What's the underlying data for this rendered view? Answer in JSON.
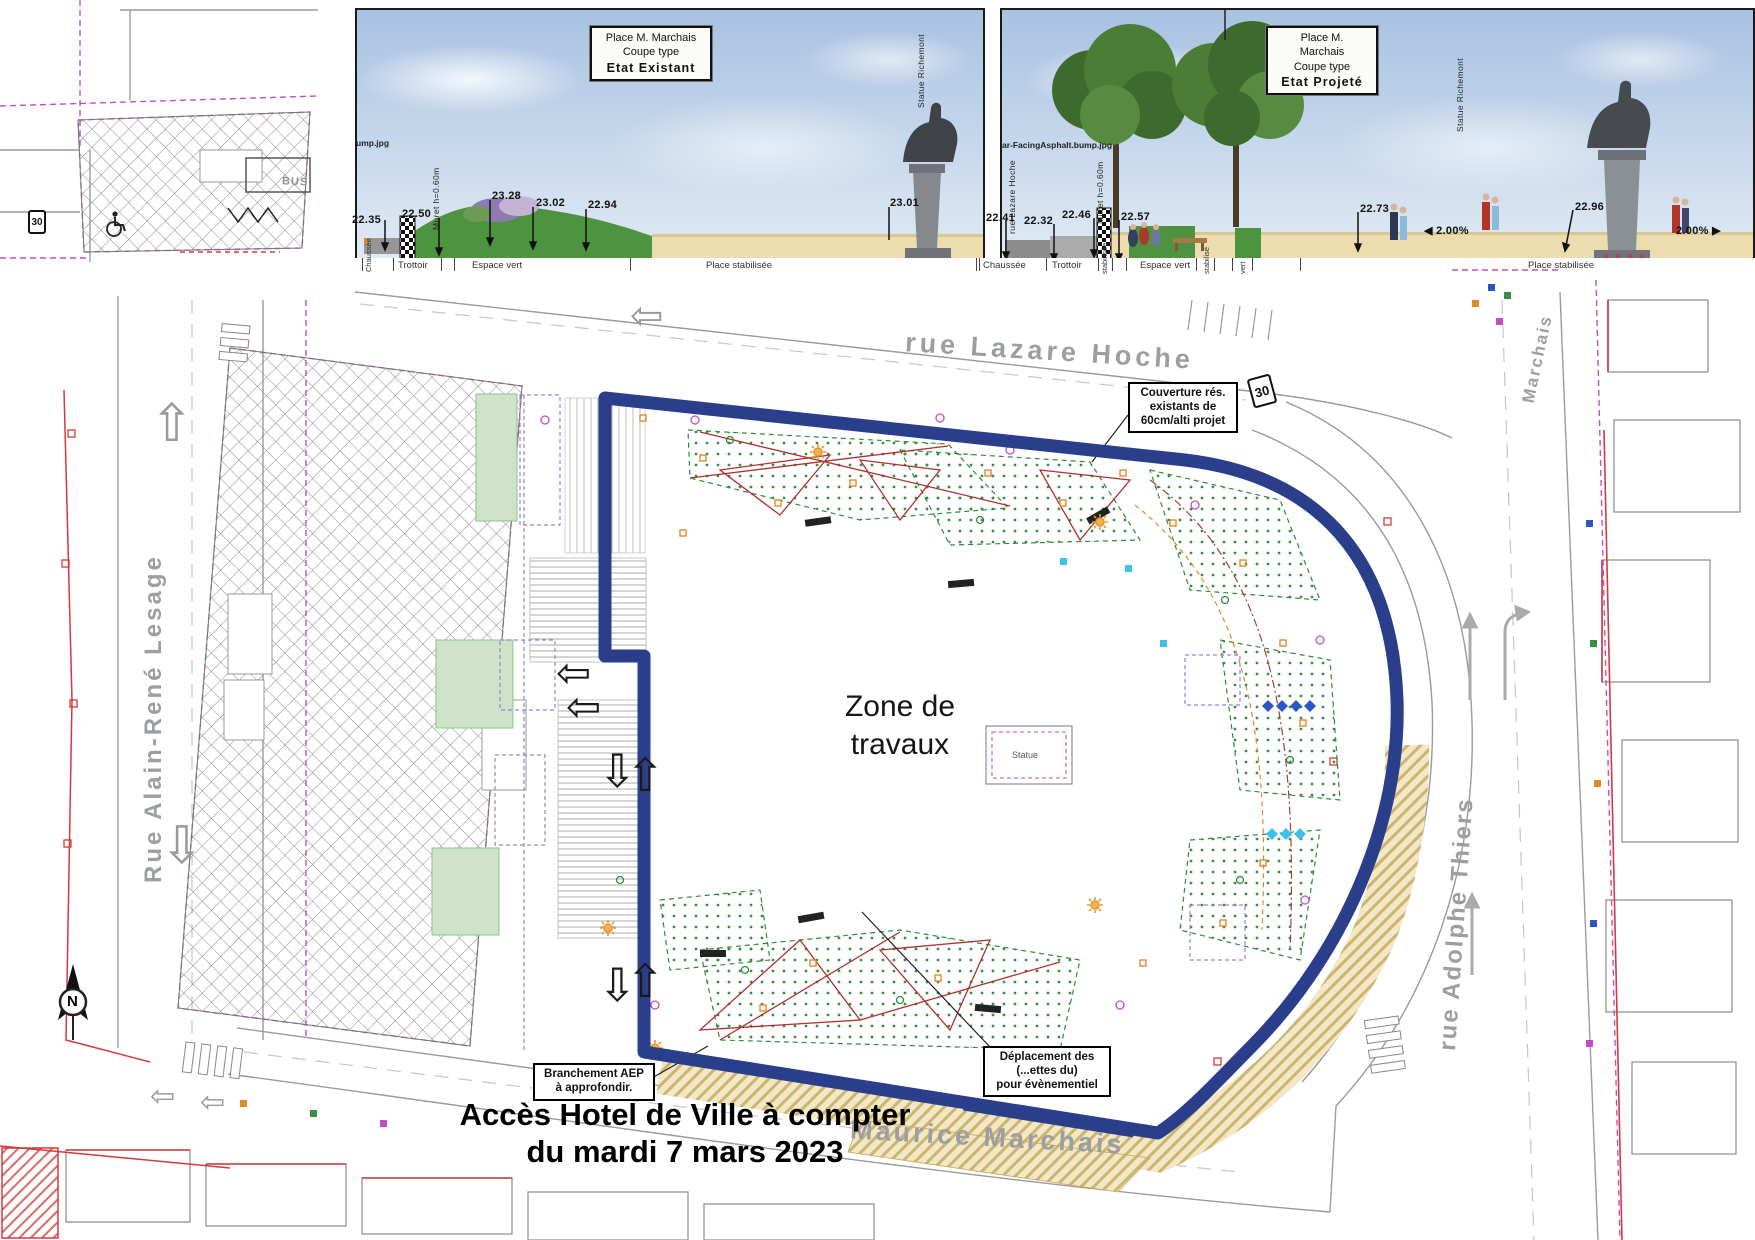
{
  "sections": {
    "existing": {
      "title": [
        "Place M. Marchais",
        "Coupe type",
        "Etat Existant"
      ],
      "texture_note": "ump.jpg",
      "muret": "Muret h=0.60m",
      "statue": "Statue Richemont",
      "elev": {
        "e1": "22.35",
        "e2": "22.50",
        "e3": "23.28",
        "e4": "23.02",
        "e5": "22.94",
        "e6": "23.01"
      },
      "ground": {
        "g0": "Chaussée",
        "g1": "Trottoir",
        "g2": "Espace vert",
        "g3": "Place stabilisée"
      }
    },
    "projected": {
      "title": [
        "Place M. Marchais",
        "Coupe type",
        "Etat Projeté"
      ],
      "texture_note": "ar-FacingAsphalt.bump.jpg",
      "street": "rue Lazare Hoche",
      "muret": "Muret h=0.60m",
      "statue": "Statue Richemont",
      "elev": {
        "e1": "22.41",
        "e2": "22.32",
        "e3": "22.46",
        "e4": "22.57",
        "e5": "22.73",
        "e6": "22.96"
      },
      "slope1": "2.00%",
      "slope2": "2.00%",
      "ground": {
        "g1": "Chaussée",
        "g2": "Trottoir",
        "g3": "stabilisée",
        "g4": "Espace vert",
        "g5": "stabilisé",
        "g6": "vert",
        "g7": "Place stabilisée"
      }
    }
  },
  "plan": {
    "zone": {
      "line1": "Zone de",
      "line2": "travaux"
    },
    "statue_box": "Statue",
    "streets": {
      "top": "rue Lazare Hoche",
      "left": "Rue Alain-René Lesage",
      "right": "rue Adolphe Thiers",
      "bottom": "Maurice Marchais",
      "corner": "Marchais"
    },
    "notes": {
      "couverture": {
        "l1": "Couverture rés.",
        "l2": "existants de",
        "l3": "60cm/alti projet"
      },
      "branchement": {
        "l1": "Branchement AEP",
        "l2": "à approfondir."
      },
      "deplacement": {
        "l1": "Déplacement des",
        "l2": "(...ettes du)",
        "l3": "pour évènementiel"
      }
    },
    "access": {
      "line1": "Accès Hotel de Ville à compter",
      "line2": "du mardi 7 mars 2023"
    },
    "bus": "BUS",
    "speed": "30",
    "north": "N"
  },
  "icons": {
    "arrow_up": "⇧",
    "arrow_down": "⇩",
    "arrow_left": "⇦",
    "slope_left": "◀",
    "slope_right": "▶"
  },
  "colors": {
    "boundary": "#2a3e8c",
    "street_text": "#9c9fa2",
    "sand": "#ecdcae",
    "green_area": "#cfe3c8"
  }
}
